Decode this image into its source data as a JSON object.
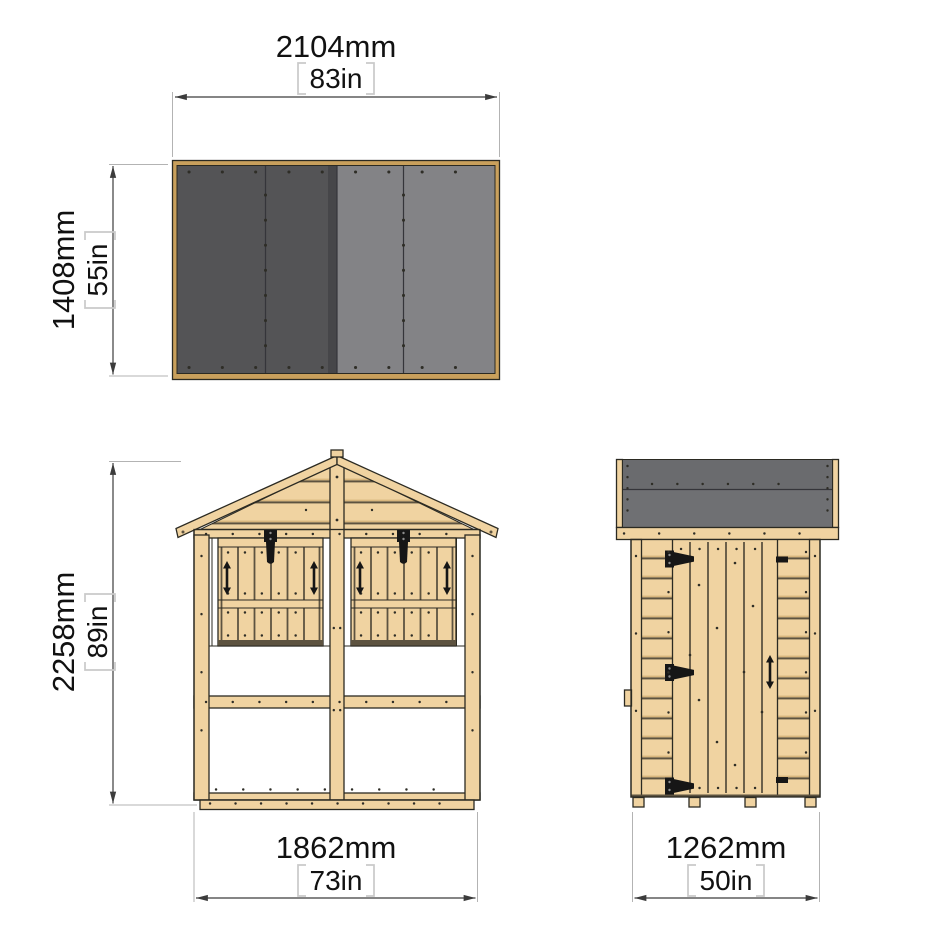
{
  "diagram": {
    "title": "shed-three-view-dimension-diagram",
    "views": {
      "roof_plan": {
        "width": {
          "mm": "2104mm",
          "in": "83in"
        },
        "depth": {
          "mm": "1408mm",
          "in": "55in"
        }
      },
      "front": {
        "height": {
          "mm": "2258mm",
          "in": "89in"
        },
        "width": {
          "mm": "1862mm",
          "in": "73in"
        }
      },
      "side": {
        "width": {
          "mm": "1262mm",
          "in": "50in"
        }
      }
    }
  },
  "colors": {
    "canvas": "#ffffff",
    "wood": "#f0d3a1",
    "wood_shade": "#d9b77e",
    "frame_wood": "#c9a05c",
    "plank_gap": "#5d5340",
    "outline": "#2b2a22",
    "roof_dark": "#545456",
    "roof_light": "#838386",
    "roof_mid": "#6a6b6e",
    "roof_seam": "#35353a",
    "screw": "#2e2d26",
    "hardware": "#161616",
    "dim_line": "#3c3c3c",
    "ext_line": "#b3b3b3",
    "bracket": "#c9c9c9",
    "text": "#111111"
  }
}
